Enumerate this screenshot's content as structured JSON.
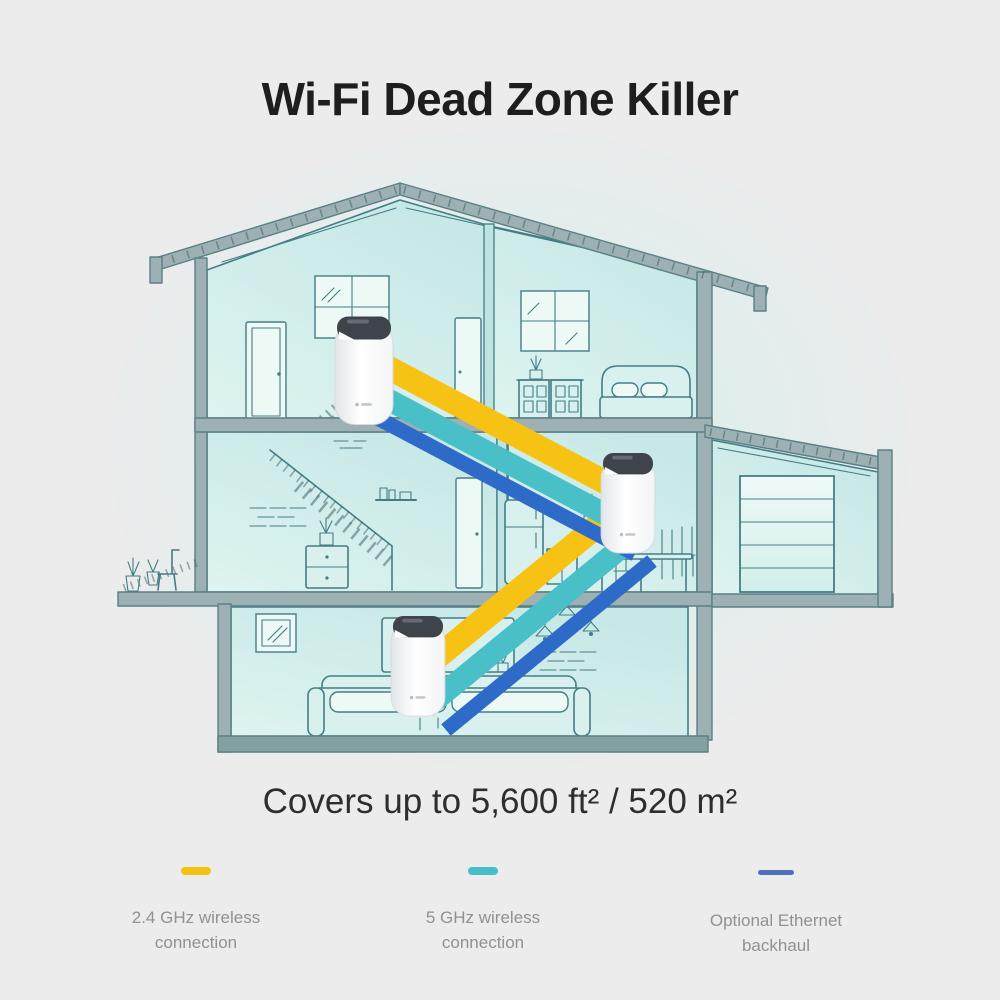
{
  "title": "Wi-Fi Dead Zone Killer",
  "coverage": "Covers up to 5,600 ft² / 520 m²",
  "legend": {
    "items": [
      {
        "label": "2.4 GHz wireless connection",
        "color": "#f2c211"
      },
      {
        "label": "5 GHz wireless connection",
        "color": "#47bfc8"
      },
      {
        "label": "Optional Ethernet backhaul",
        "color": "#4c70bc"
      }
    ]
  },
  "icons": {
    "deco_unit": "deco-mesh-router",
    "house": "house-cross-section"
  },
  "colors": {
    "background": "#ececec",
    "blob": "#d8eeea",
    "line": "#447d86",
    "slab": "#9db0b3",
    "slab_edge": "#5a8086",
    "slab_dark": "#85a0a0",
    "band_yellow": "#f6c315",
    "band_teal": "#49c0c8",
    "band_blue": "#2e6bc8",
    "unit_cap": "#3f444a",
    "title_text": "#1e1e1e",
    "body_text": "#2e2e2e",
    "legend_text": "#8f9193"
  }
}
